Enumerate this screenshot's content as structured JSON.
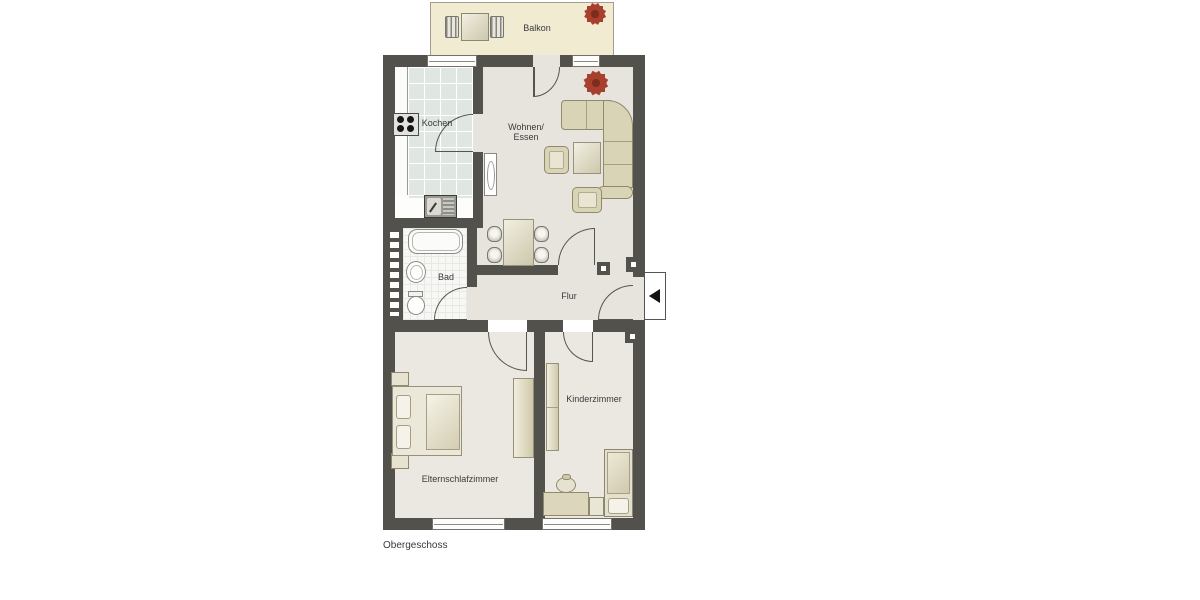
{
  "plan": {
    "floor_label": "Obergeschoss",
    "colors": {
      "wall": "#52514c",
      "floor": "#e7e4de",
      "balcony_floor": "#f1ebd2",
      "kitchen_tile": "#e0e6e1",
      "furniture_beige": "#d9d4b6",
      "plant_red": "#a8402e",
      "label_text": "#3a3a3a"
    },
    "rooms": {
      "balcony": {
        "label": "Balkon",
        "furniture": [
          "patio-table",
          "patio-chair-left",
          "patio-chair-right",
          "plant-starburst"
        ]
      },
      "kitchen": {
        "label": "Kochen",
        "furniture": [
          "counter",
          "stove",
          "sink-unit",
          "tiled-floor"
        ]
      },
      "living": {
        "label_line1": "Wohnen/",
        "label_line2": "Essen",
        "furniture": [
          "corner-sofa",
          "coffee-table",
          "armchair",
          "armchair",
          "dining-table",
          "dining-chair-x4",
          "radiator-cabinet",
          "plant-starburst"
        ]
      },
      "bath": {
        "label": "Bad",
        "furniture": [
          "bathtub",
          "washbasin",
          "toilet",
          "glass-block-wall"
        ]
      },
      "hall": {
        "label": "Flur",
        "furniture": []
      },
      "kids_room": {
        "label": "Kinderzimmer",
        "furniture": [
          "wardrobe",
          "desk",
          "desk-chair",
          "single-bed",
          "pillow",
          "nightstand"
        ]
      },
      "parents_room": {
        "label": "Elternschlafzimmer",
        "furniture": [
          "double-bed",
          "pillow",
          "pillow",
          "nightstand",
          "nightstand",
          "wardrobe"
        ]
      }
    },
    "entrance": {
      "marker": "entrance-arrow",
      "door": "entrance-door-leaf"
    }
  }
}
